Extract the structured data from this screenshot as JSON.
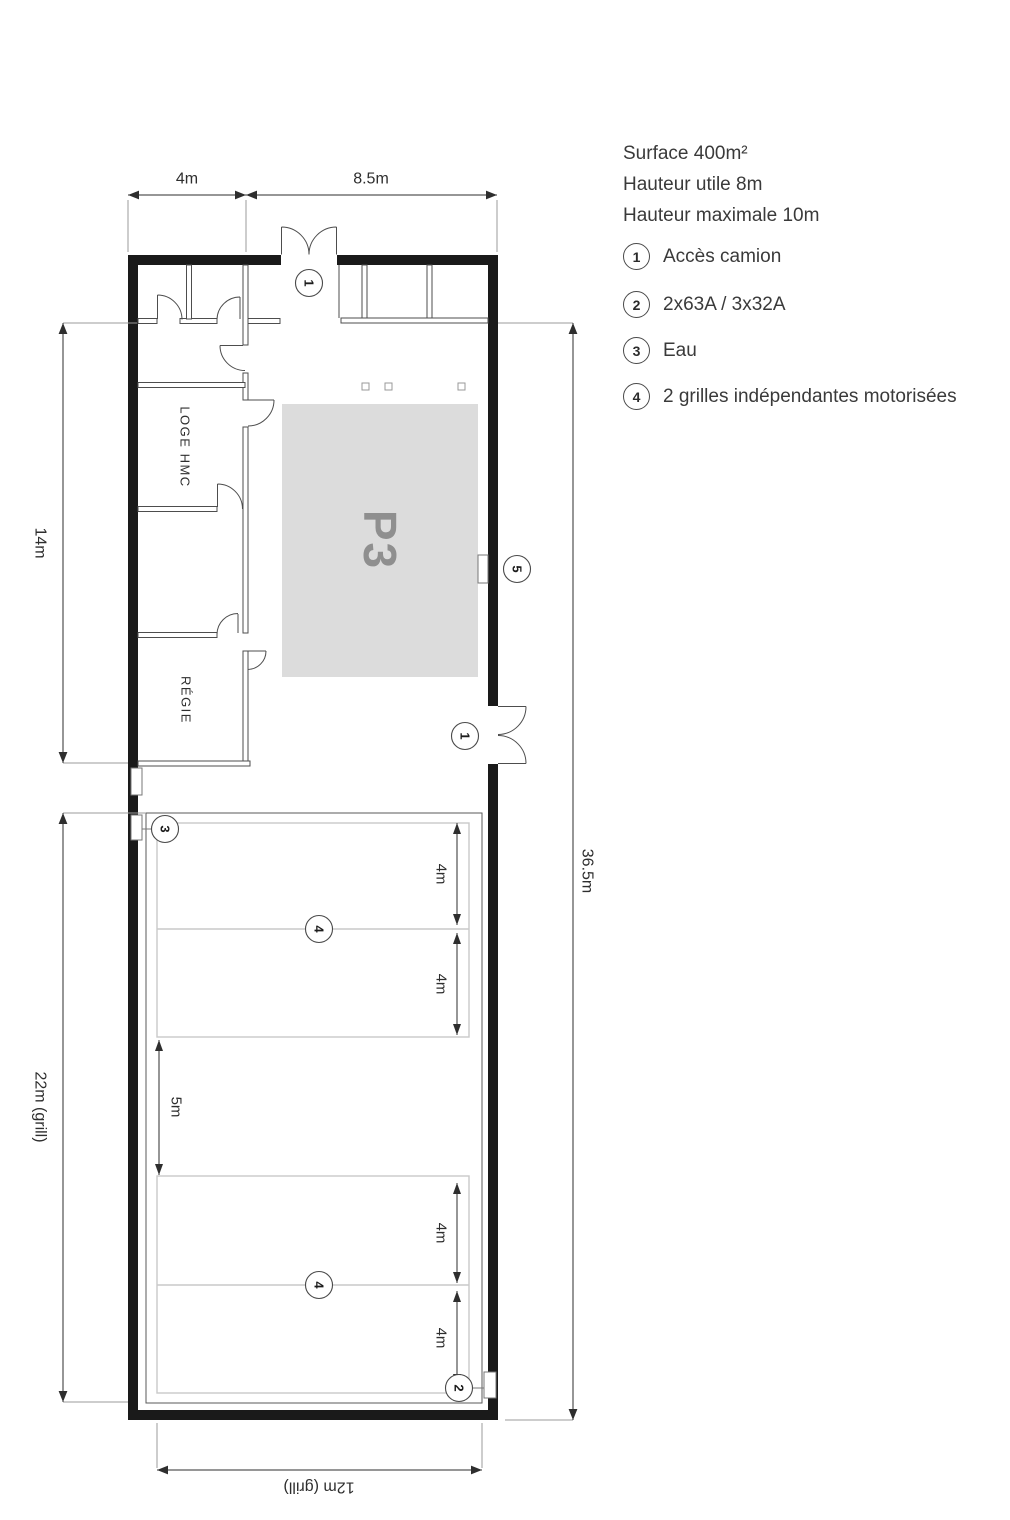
{
  "legend": {
    "titles": [
      "Surface 400m²",
      "Hauteur utile 8m",
      "Hauteur maximale 10m"
    ],
    "items": [
      {
        "num": "1",
        "label": "Accès camion"
      },
      {
        "num": "2",
        "label": "2x63A / 3x32A"
      },
      {
        "num": "3",
        "label": "Eau"
      },
      {
        "num": "4",
        "label": "2 grilles indépendantes motorisées"
      }
    ]
  },
  "plan": {
    "rooms": {
      "loge": "LOGE HMC",
      "regie": "RÉGIE",
      "stage": "P3"
    },
    "dims": {
      "top_left": "4m",
      "top_right": "8.5m",
      "left_upper": "14m",
      "left_lower": "22m (grill)",
      "right_side": "36.5m",
      "bottom": "12m (grill)",
      "grill_span": "4m",
      "grill_gap": "5m"
    },
    "markers": {
      "truck_top": "1",
      "truck_right": "1",
      "power": "2",
      "water": "3",
      "grille_upper": "4",
      "grille_lower": "4",
      "hatch": "5"
    }
  },
  "colors": {
    "wall": "#1a1a1a",
    "thin_wall": "#4d4d4d",
    "dimension": "#2e2e2e",
    "extension": "#9b9b9b",
    "grill_light": "#c9c9c9",
    "stage_fill": "#dcdcdc",
    "stage_text": "#8f8f8f",
    "text": "#3a3a3a"
  }
}
